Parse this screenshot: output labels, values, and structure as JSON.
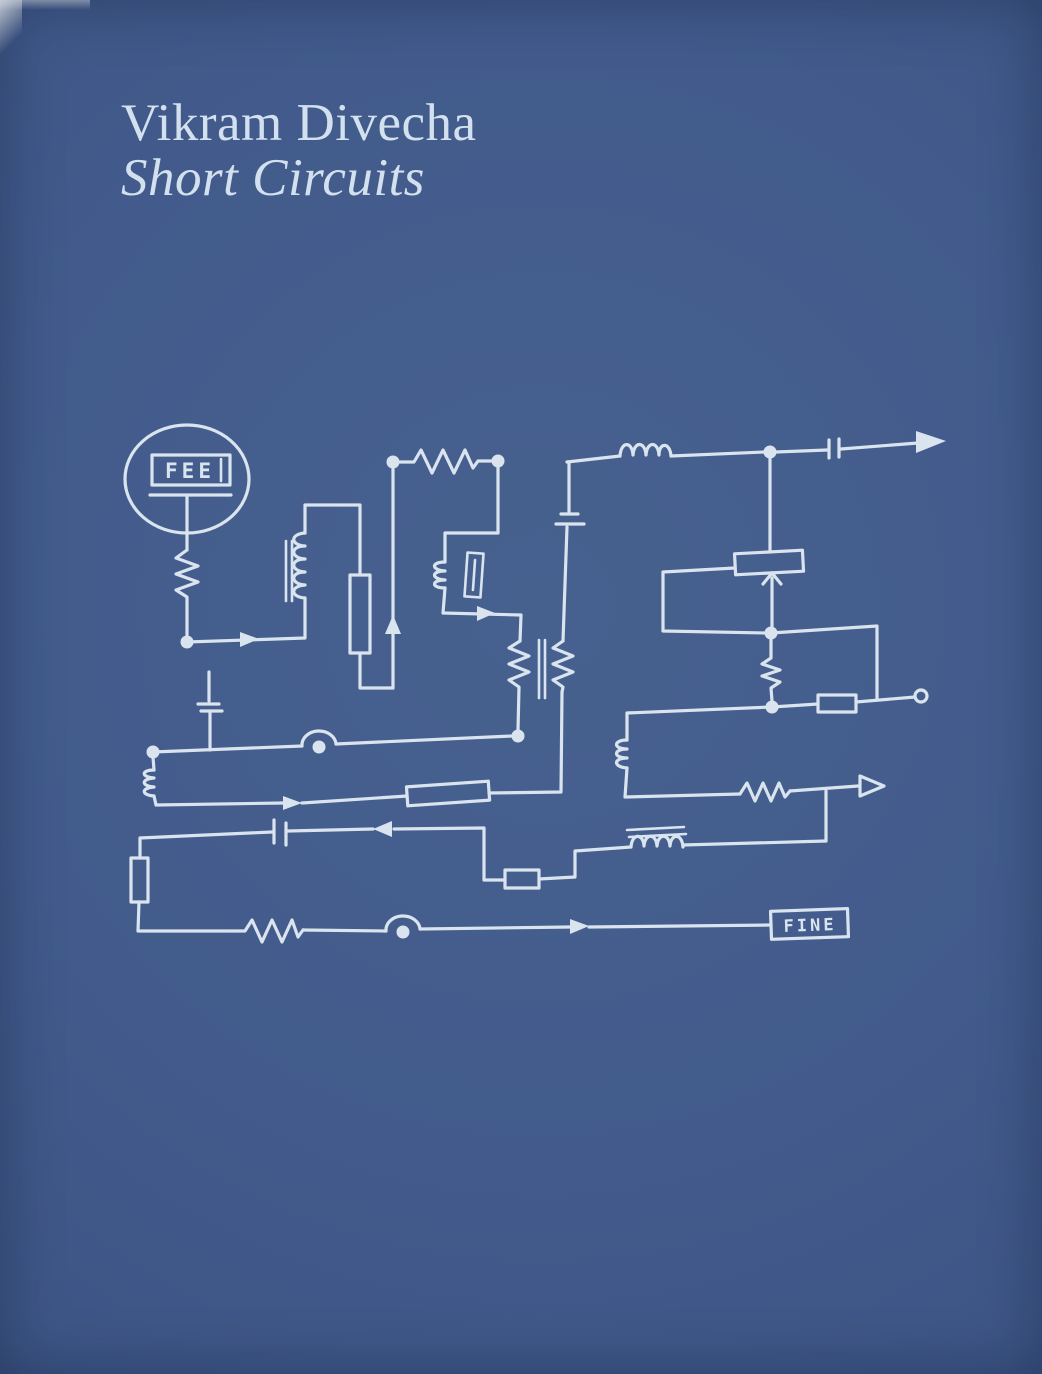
{
  "cover": {
    "title": "Vikram Divecha",
    "subtitle": "Short Circuits"
  },
  "diagram": {
    "start_label": "FEE",
    "end_label": "FINE",
    "components": [
      {
        "type": "circle-terminal",
        "label": "FEE"
      },
      {
        "type": "zigzag-resistor",
        "count": 7
      },
      {
        "type": "box-resistor",
        "count": 5
      },
      {
        "type": "inductor-coil",
        "count": 6
      },
      {
        "type": "transformer-core-bars",
        "count": 3
      },
      {
        "type": "capacitor",
        "count": 4
      },
      {
        "type": "potentiometer-with-wiper-arrow",
        "count": 1
      },
      {
        "type": "wire-hop-with-dot",
        "count": 2
      },
      {
        "type": "junction-dot",
        "count": 8
      },
      {
        "type": "open-terminal-circle",
        "count": 1
      },
      {
        "type": "arrowhead",
        "count": 9
      },
      {
        "type": "box-terminal",
        "label": "FINE"
      }
    ]
  },
  "colors": {
    "background": "#3f578a",
    "ink": "#d9e4ef",
    "title_text": "#d3e1ef"
  }
}
